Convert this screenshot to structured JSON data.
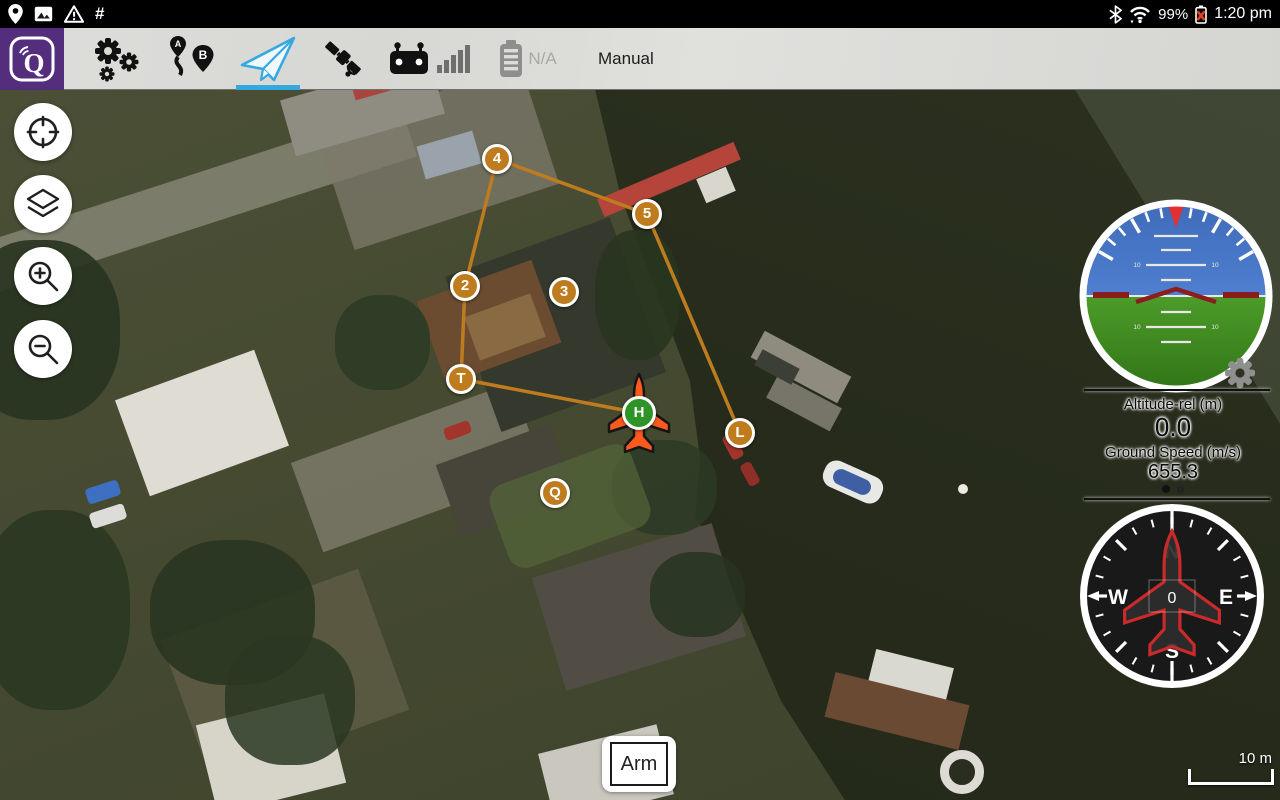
{
  "status_bar": {
    "time": "1:20 pm",
    "battery_percent": "99%",
    "hash_symbol": "#"
  },
  "toolbar": {
    "app_name": "QGroundControl",
    "accent_color": "#35a8e0",
    "battery_status": "N/A",
    "flight_mode": "Manual",
    "selected_tab": "fly"
  },
  "map": {
    "type": "satellite",
    "scale_label": "10 m",
    "waypoint_color": "#bf7c1f",
    "home_color": "#2e9428",
    "waypoints": [
      {
        "label": "4",
        "x": 497,
        "y": 159,
        "kind": "numbered"
      },
      {
        "label": "5",
        "x": 647,
        "y": 214,
        "kind": "numbered"
      },
      {
        "label": "2",
        "x": 465,
        "y": 286,
        "kind": "numbered"
      },
      {
        "label": "3",
        "x": 564,
        "y": 292,
        "kind": "numbered"
      },
      {
        "label": "T",
        "x": 461,
        "y": 379,
        "kind": "takeoff"
      },
      {
        "label": "L",
        "x": 740,
        "y": 433,
        "kind": "land"
      },
      {
        "label": "Q",
        "x": 555,
        "y": 493,
        "kind": "numbered"
      },
      {
        "label": "H",
        "x": 639,
        "y": 413,
        "kind": "home"
      }
    ],
    "path": [
      [
        "2",
        "4"
      ],
      [
        "4",
        "5"
      ],
      [
        "5",
        "L"
      ],
      [
        "2",
        "T"
      ],
      [
        "T",
        "H"
      ]
    ],
    "vehicle": {
      "at": "H",
      "color": "#ff5a1e"
    }
  },
  "instruments": {
    "attitude": {
      "pitch_label": "10",
      "sky_color": "#4674c4",
      "ground_color": "#3f8d20"
    },
    "altitude_label": "Altitude-rel (m)",
    "altitude_value": "0.0",
    "ground_speed_label": "Ground Speed (m/s)",
    "ground_speed_value": "655.3",
    "compass": {
      "heading": "0",
      "cardinal_n": "N",
      "cardinal_e": "E",
      "cardinal_s": "S",
      "cardinal_w": "W"
    }
  },
  "arm_button": {
    "label": "Arm"
  }
}
